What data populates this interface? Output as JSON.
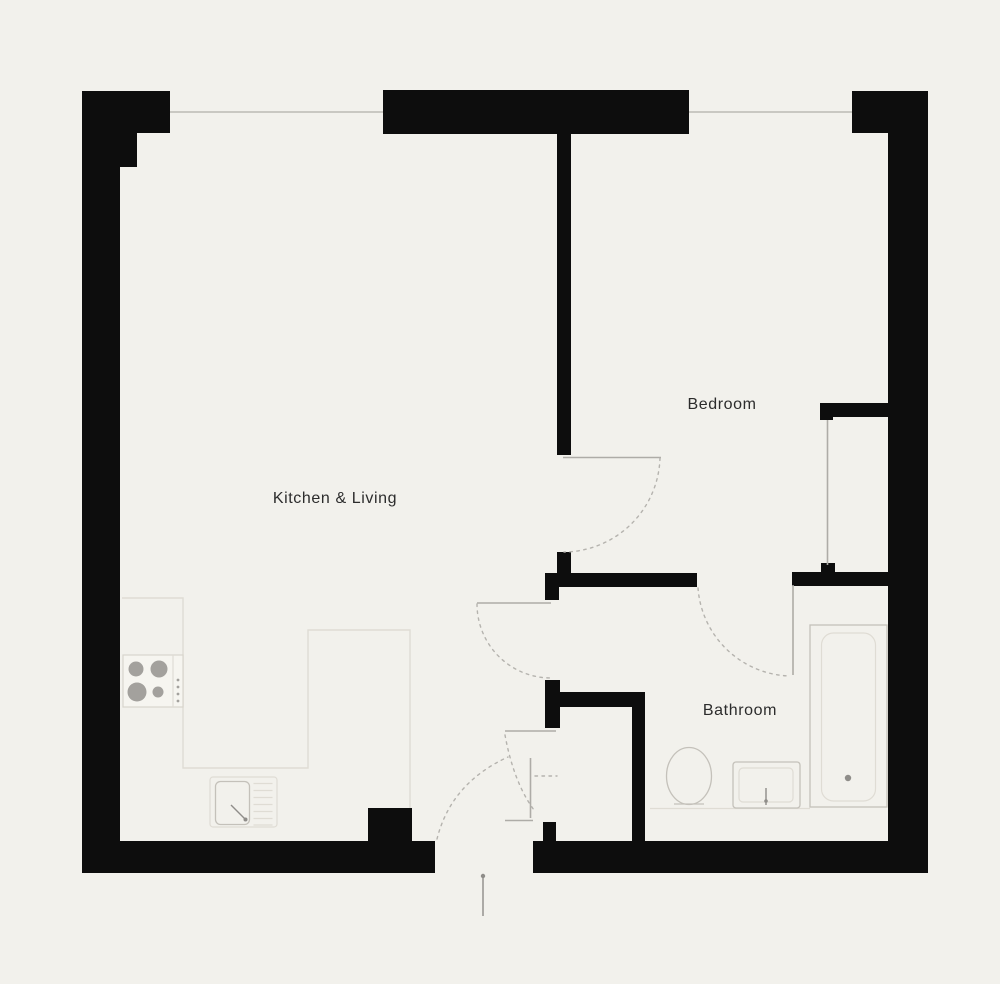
{
  "colors": {
    "background": "#f2f1ec",
    "wall": "#0d0d0d",
    "window_line": "#c9c8c2",
    "door_leaf": "#aeaca7",
    "door_swing": "#b5b3ae",
    "counter_line": "#dfdcd4",
    "fixture_line": "#c4c1ba",
    "fixture_detail": "#8f8d89",
    "label_text": "#2c2c2c"
  },
  "rooms": [
    {
      "name": "kitchen-living",
      "label": "Kitchen & Living"
    },
    {
      "name": "bedroom",
      "label": "Bedroom"
    },
    {
      "name": "bathroom",
      "label": "Bathroom"
    }
  ],
  "fixtures": [
    {
      "name": "stove",
      "room": "kitchen-living",
      "burners": 4
    },
    {
      "name": "kitchen-sink",
      "room": "kitchen-living"
    },
    {
      "name": "kitchen-counter",
      "room": "kitchen-living"
    },
    {
      "name": "toilet",
      "room": "bathroom"
    },
    {
      "name": "washbasin",
      "room": "bathroom"
    },
    {
      "name": "bathtub",
      "room": "bathroom"
    },
    {
      "name": "wardrobe",
      "room": "bedroom"
    }
  ],
  "openings": {
    "windows": [
      {
        "name": "kitchen-living-window"
      },
      {
        "name": "bedroom-window"
      }
    ],
    "doors": [
      {
        "name": "bedroom-door"
      },
      {
        "name": "kitchen-door"
      },
      {
        "name": "bathroom-door"
      },
      {
        "name": "entrance-door"
      },
      {
        "name": "hall-closet-door"
      }
    ],
    "entrance_marker": {
      "name": "entrance-arrow"
    }
  }
}
